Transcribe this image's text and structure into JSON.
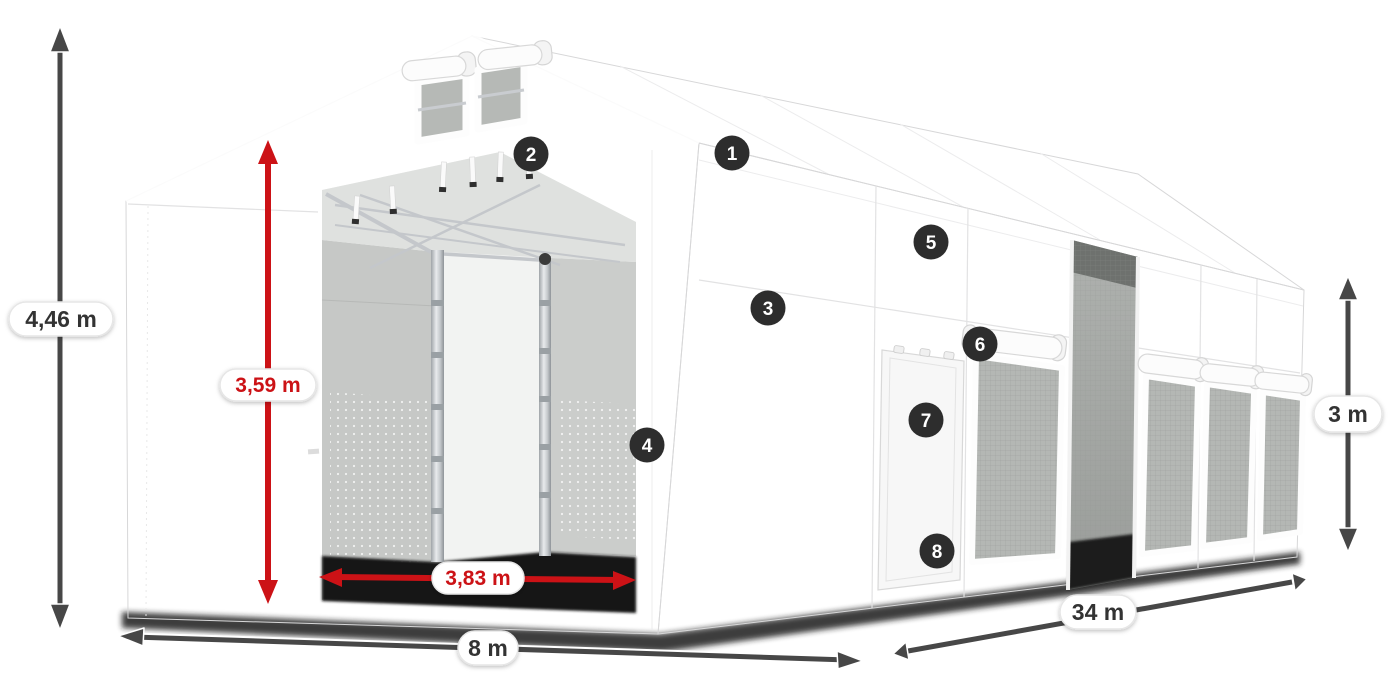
{
  "diagram": {
    "dimensions": {
      "total_height": "4,46 m",
      "inner_height": "3,59 m",
      "door_width": "3,83 m",
      "front_width": "8 m",
      "length": "34 m",
      "side_height": "3 m"
    },
    "markers": [
      {
        "label": "1"
      },
      {
        "label": "2"
      },
      {
        "label": "3"
      },
      {
        "label": "4"
      },
      {
        "label": "5"
      },
      {
        "label": "6"
      },
      {
        "label": "7"
      },
      {
        "label": "8"
      }
    ],
    "colors": {
      "accent_red": "#cc1216",
      "dim_arrow": "#474747",
      "dim_text": "#333333",
      "marker_bg": "#2d2d2d",
      "marker_text": "#ffffff"
    }
  }
}
